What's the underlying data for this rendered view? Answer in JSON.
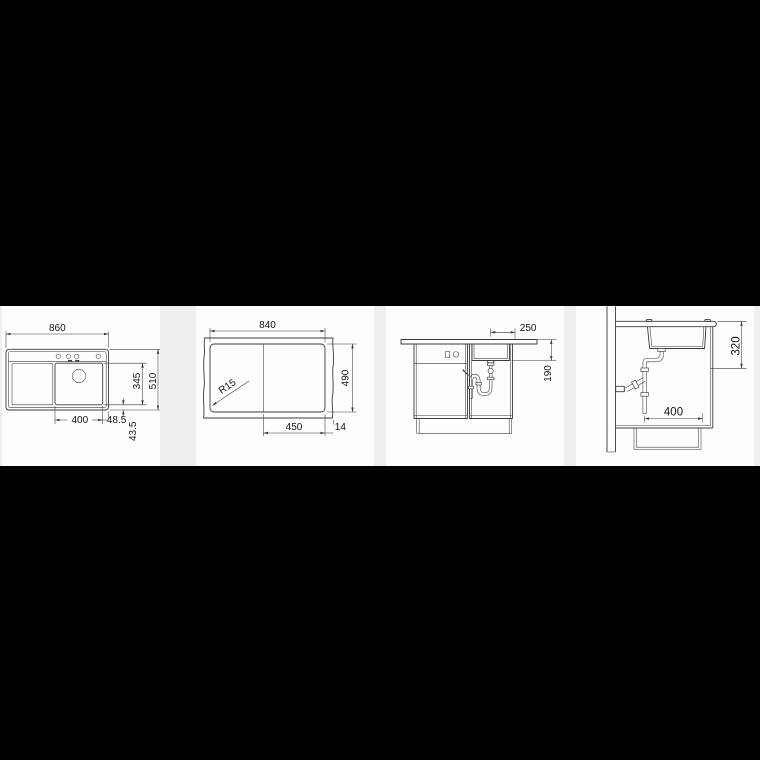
{
  "page": {
    "background": "#000000",
    "strip_background": "#efeff0",
    "card_background": "#fdfdfd",
    "line_color": "#3b3b3b"
  },
  "panels": {
    "top_view": {
      "overall_width": "860",
      "overall_depth": "510",
      "bowl_depth": "345",
      "bowl_width": "400",
      "bowl_offset_right": "48.5",
      "bowl_offset_front": "43.5"
    },
    "cutout_view": {
      "cutout_width": "840",
      "cutout_depth": "490",
      "corner_radius": "R15",
      "right_section_width": "450",
      "edge_gap": "14"
    },
    "front_view": {
      "drain_to_edge": "250",
      "depth_below_worktop": "190"
    },
    "side_view": {
      "depth_below_worktop": "320",
      "drain_distance": "400"
    }
  }
}
